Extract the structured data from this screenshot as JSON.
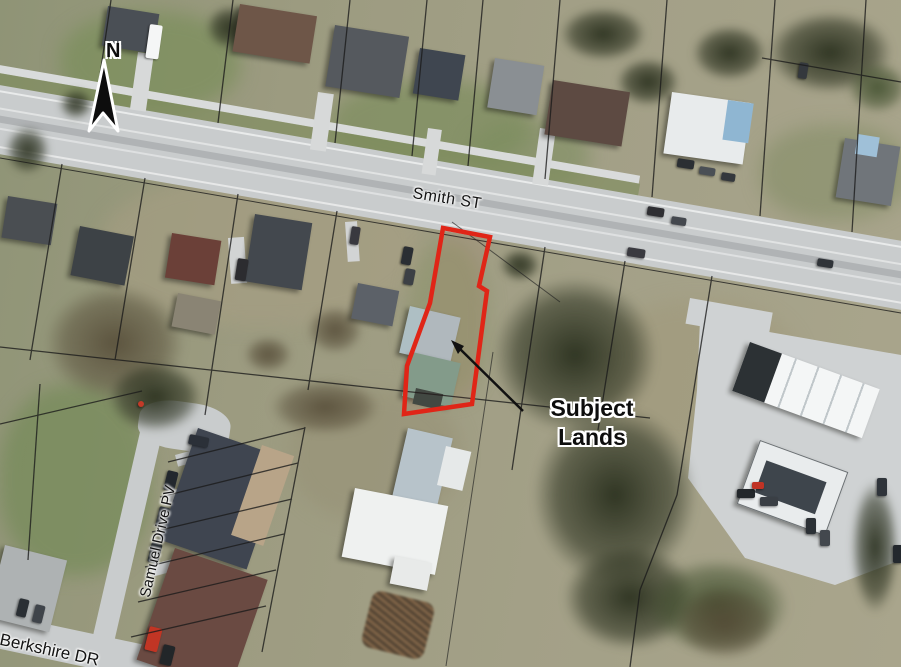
{
  "map": {
    "type": "aerial-photo-with-parcel-overlay",
    "north_arrow": {
      "label": "N"
    },
    "labels": {
      "smith_st": "Smith ST",
      "samuel_drive": "Samuel Drive PV",
      "berkshire_dr": "Berkshire DR",
      "subject_lands": "Subject Lands"
    },
    "colors": {
      "subject_outline": "#e02517",
      "parcel_line": "#1a1a1a",
      "road": "#c9cccd",
      "annotation_arrow": "#111111"
    }
  }
}
